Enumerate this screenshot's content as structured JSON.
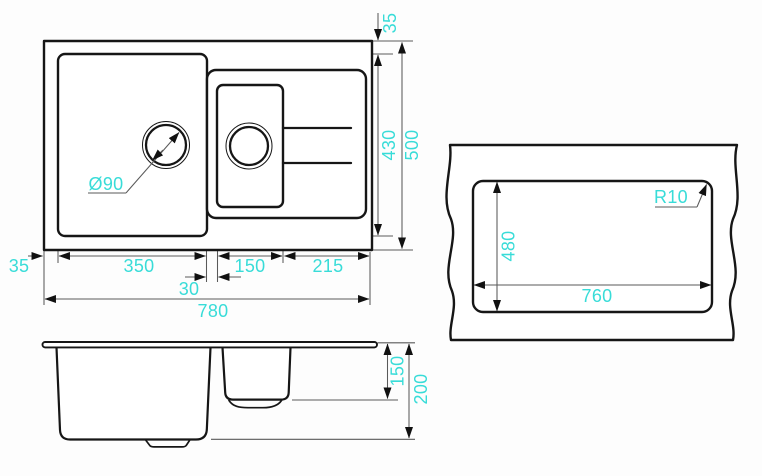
{
  "drawing": {
    "kind": "kitchen sink installation drawing",
    "colors": {
      "dimension_text": "#38DCD8",
      "object_lines": "#161616"
    }
  },
  "top_view": {
    "rim_offset_top": "35",
    "bowl_zone_height": "430",
    "overall_depth": "500",
    "rim_offset_left": "35",
    "main_bowl_width": "350",
    "bowl_gap": "30",
    "half_bowl_width": "150",
    "drainer_width": "215",
    "overall_width": "780",
    "drain_diameter": "Ø90"
  },
  "cutout_view": {
    "cutout_height": "480",
    "cutout_width": "760",
    "corner_radius": "R10"
  },
  "side_view": {
    "half_bowl_depth": "150",
    "main_bowl_depth": "200"
  }
}
